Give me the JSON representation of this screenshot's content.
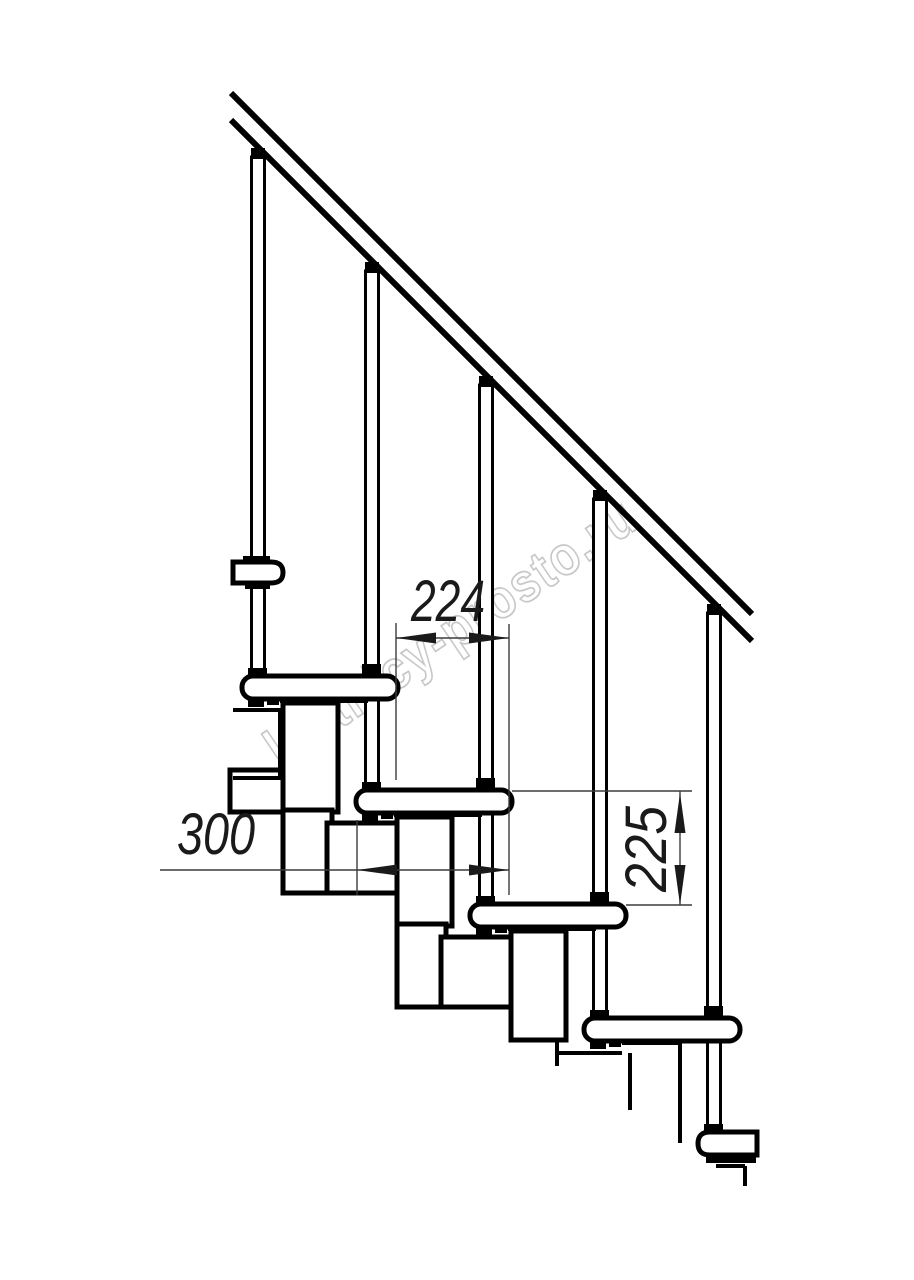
{
  "drawing": {
    "title": "modular-staircase-side-view",
    "watermark": {
      "text": "lestnicy-prosto.ru",
      "color": "#9a9a9a"
    },
    "dimensions": {
      "run_between_noses": "224",
      "tread_depth": "300",
      "riser_height": "225"
    },
    "colors": {
      "ink": "#000000",
      "dimension_lines": "#3c3c3c",
      "background": "#ffffff"
    }
  }
}
